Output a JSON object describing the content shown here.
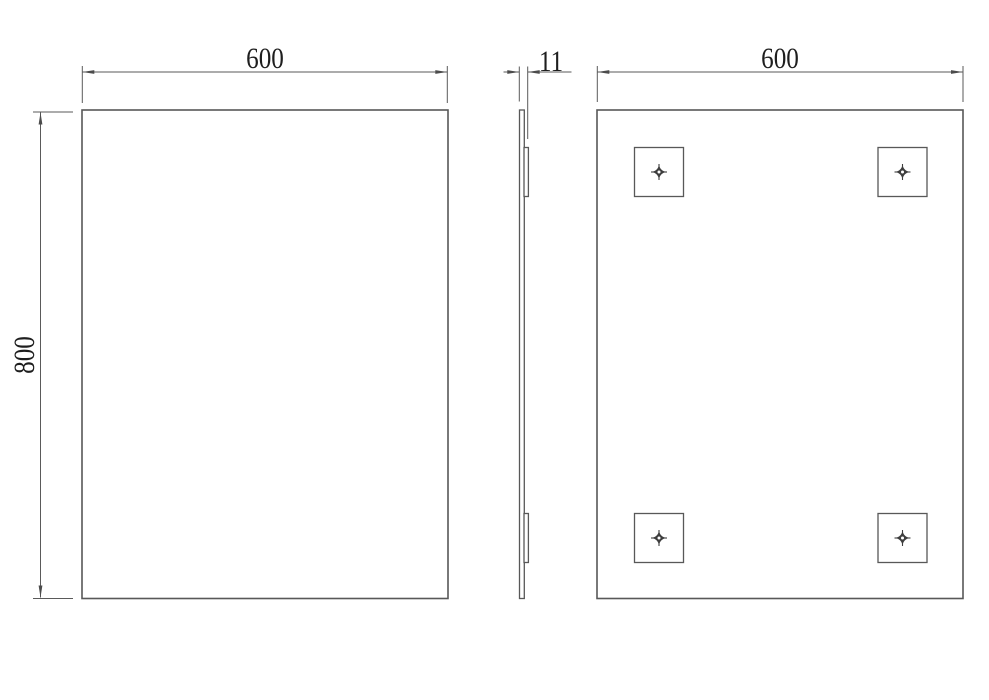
{
  "drawing": {
    "kind": "technical-dimension-drawing",
    "views": {
      "front": {
        "width_label": "600",
        "height_label": "800"
      },
      "side": {
        "thickness_label": "11"
      },
      "back": {
        "width_label": "600",
        "fixing_point_count": 4
      }
    },
    "icons": {
      "fixing_point": "crosshair-registration-mark"
    },
    "colors": {
      "background": "#ffffff",
      "line": "#585858",
      "text": "#1e1e1e"
    }
  }
}
